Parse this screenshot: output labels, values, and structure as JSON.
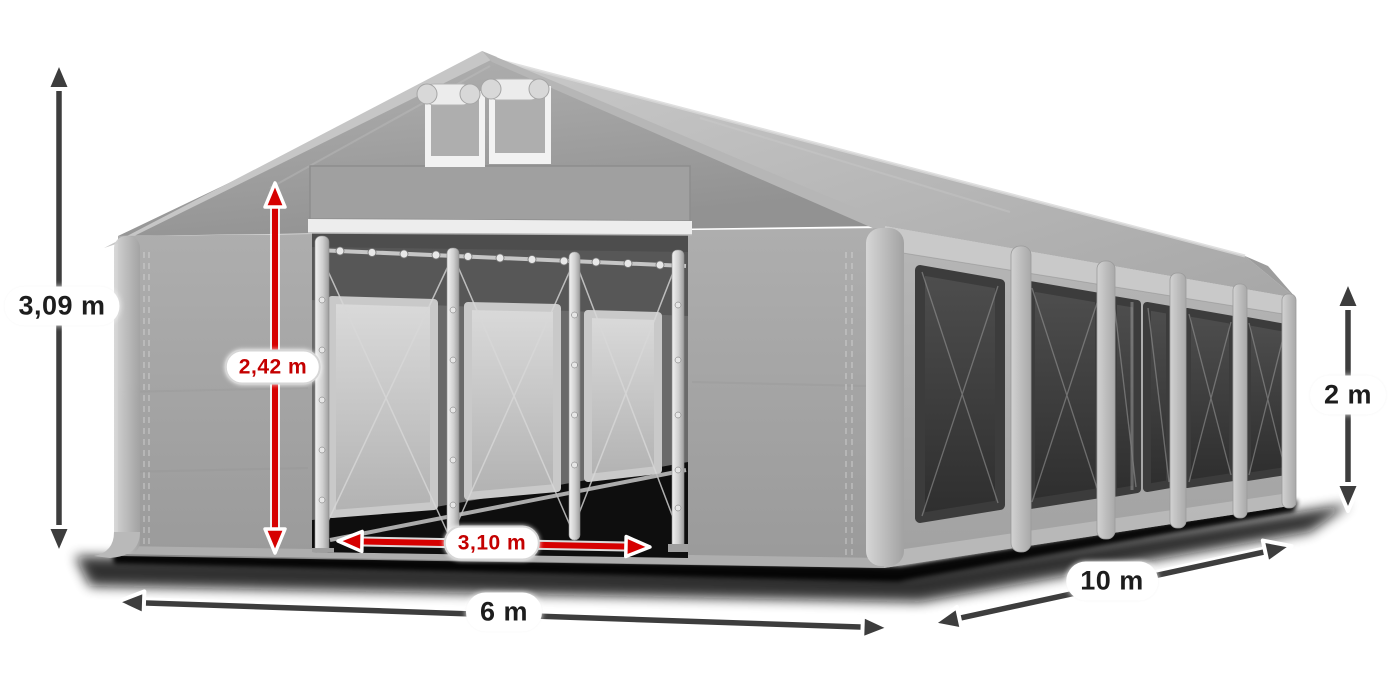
{
  "diagram": {
    "name": "party-tent-dimension-diagram",
    "background": "#ffffff",
    "tent_color": "#a6a6a6",
    "window_color": "#3c3c3c",
    "accent_red": "#d60000",
    "arrow_dark": "#3d3d3d"
  },
  "dimensions": {
    "total_height": {
      "label": "3,09 m",
      "style": "dark",
      "orientation": "vertical",
      "measures": "total height"
    },
    "entrance_height": {
      "label": "2,42 m",
      "style": "red",
      "orientation": "vertical",
      "measures": "entrance height"
    },
    "entrance_width": {
      "label": "3,10 m",
      "style": "red",
      "orientation": "horizontal",
      "measures": "entrance width"
    },
    "front_width": {
      "label": "6 m",
      "style": "dark",
      "orientation": "horizontal",
      "measures": "tent width"
    },
    "side_length": {
      "label": "10 m",
      "style": "dark",
      "orientation": "diagonal",
      "measures": "tent length"
    },
    "side_height": {
      "label": "2 m",
      "style": "dark",
      "orientation": "vertical",
      "measures": "side wall height"
    }
  }
}
